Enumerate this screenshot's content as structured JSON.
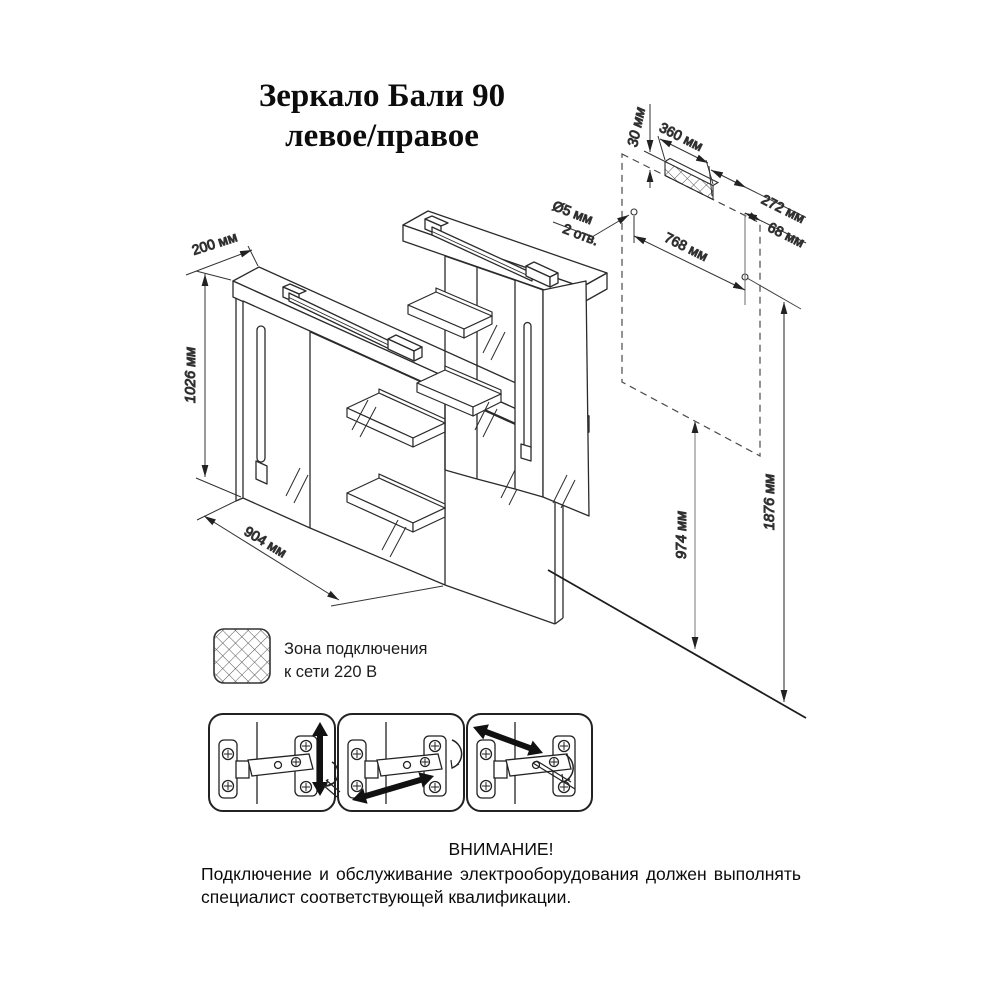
{
  "title": {
    "line1": "Зеркало Бали 90",
    "line2": "левое/правое"
  },
  "dimensions": {
    "cabinet_depth": "200 мм",
    "cabinet_height": "1026 мм",
    "cabinet_width": "904 мм",
    "zone_offset": "30 мм",
    "zone_width": "360 мм",
    "zone_to_hole": "272 мм",
    "hole_to_edge": "68 мм",
    "hole_spacing": "768 мм",
    "hole_note_line1": "Ø5 мм",
    "hole_note_line2": "2 отв.",
    "hole_height_from_floor": "974 мм",
    "top_height_from_floor": "1876 мм"
  },
  "legend": {
    "line1": "Зона подключения",
    "line2": "к сети 220 В"
  },
  "warning": {
    "heading": "ВНИМАНИЕ!",
    "body": "Подключение и обслуживание электрооборудования должен выполнять специалист соответствующей квалификации."
  },
  "colors": {
    "line": "#2b2b2b",
    "dim_line": "#3a3a3a",
    "aux_gray": "#777777",
    "paper": "#ffffff"
  }
}
